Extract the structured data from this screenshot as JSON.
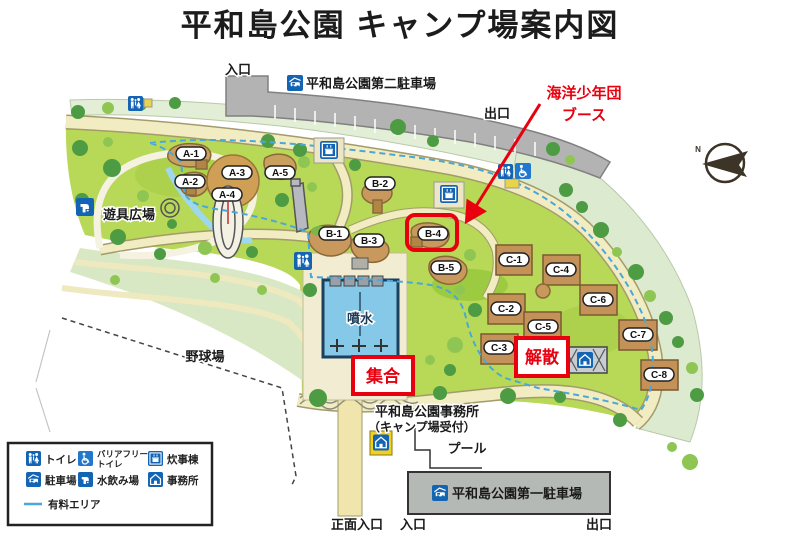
{
  "title": "平和島公園 キャンプ場案内図",
  "labels": {
    "entrance_top": "入口",
    "exit_top": "出口",
    "parking_lot2": "平和島公園第二駐車場",
    "playground": "遊具広場",
    "baseball_field": "野球場",
    "fountain": "噴水",
    "office_name": "平和島公園事務所",
    "office_note": "（キャンプ場受付）",
    "pool": "プール",
    "parking_lot1": "平和島公園第一駐車場",
    "main_gate": "正面入口",
    "entrance_bottom": "入口",
    "exit_bottom": "出口",
    "compass_north": "N"
  },
  "annotations": {
    "booth_line1": "海洋少年団",
    "booth_line2": "ブース",
    "meet": "集合",
    "disperse": "解散"
  },
  "sites": {
    "a": [
      "A-1",
      "A-2",
      "A-3",
      "A-4",
      "A-5"
    ],
    "b": [
      "B-1",
      "B-2",
      "B-3",
      "B-4",
      "B-5"
    ],
    "c": [
      "C-1",
      "C-2",
      "C-3",
      "C-4",
      "C-5",
      "C-6",
      "C-7",
      "C-8"
    ]
  },
  "legend": {
    "toilet": "トイレ",
    "barrier_free_1": "バリアフリー",
    "barrier_free_2": "トイレ",
    "cooking": "炊事棟",
    "parking": "駐車場",
    "water": "水飲み場",
    "office": "事務所",
    "paid_area": "有料エリア"
  },
  "colors": {
    "park_green": "#b8d957",
    "outer_band_green": "#dcead0",
    "road_beige": "#f1ecc2",
    "site_brown": "#c9985c",
    "fountain_blue": "#85c8e8",
    "icon_blue": "#1464b4",
    "annotation_red": "#e8000f",
    "parking_gray": "#b3b3b3",
    "paid_line_blue": "#4aa8d8"
  }
}
